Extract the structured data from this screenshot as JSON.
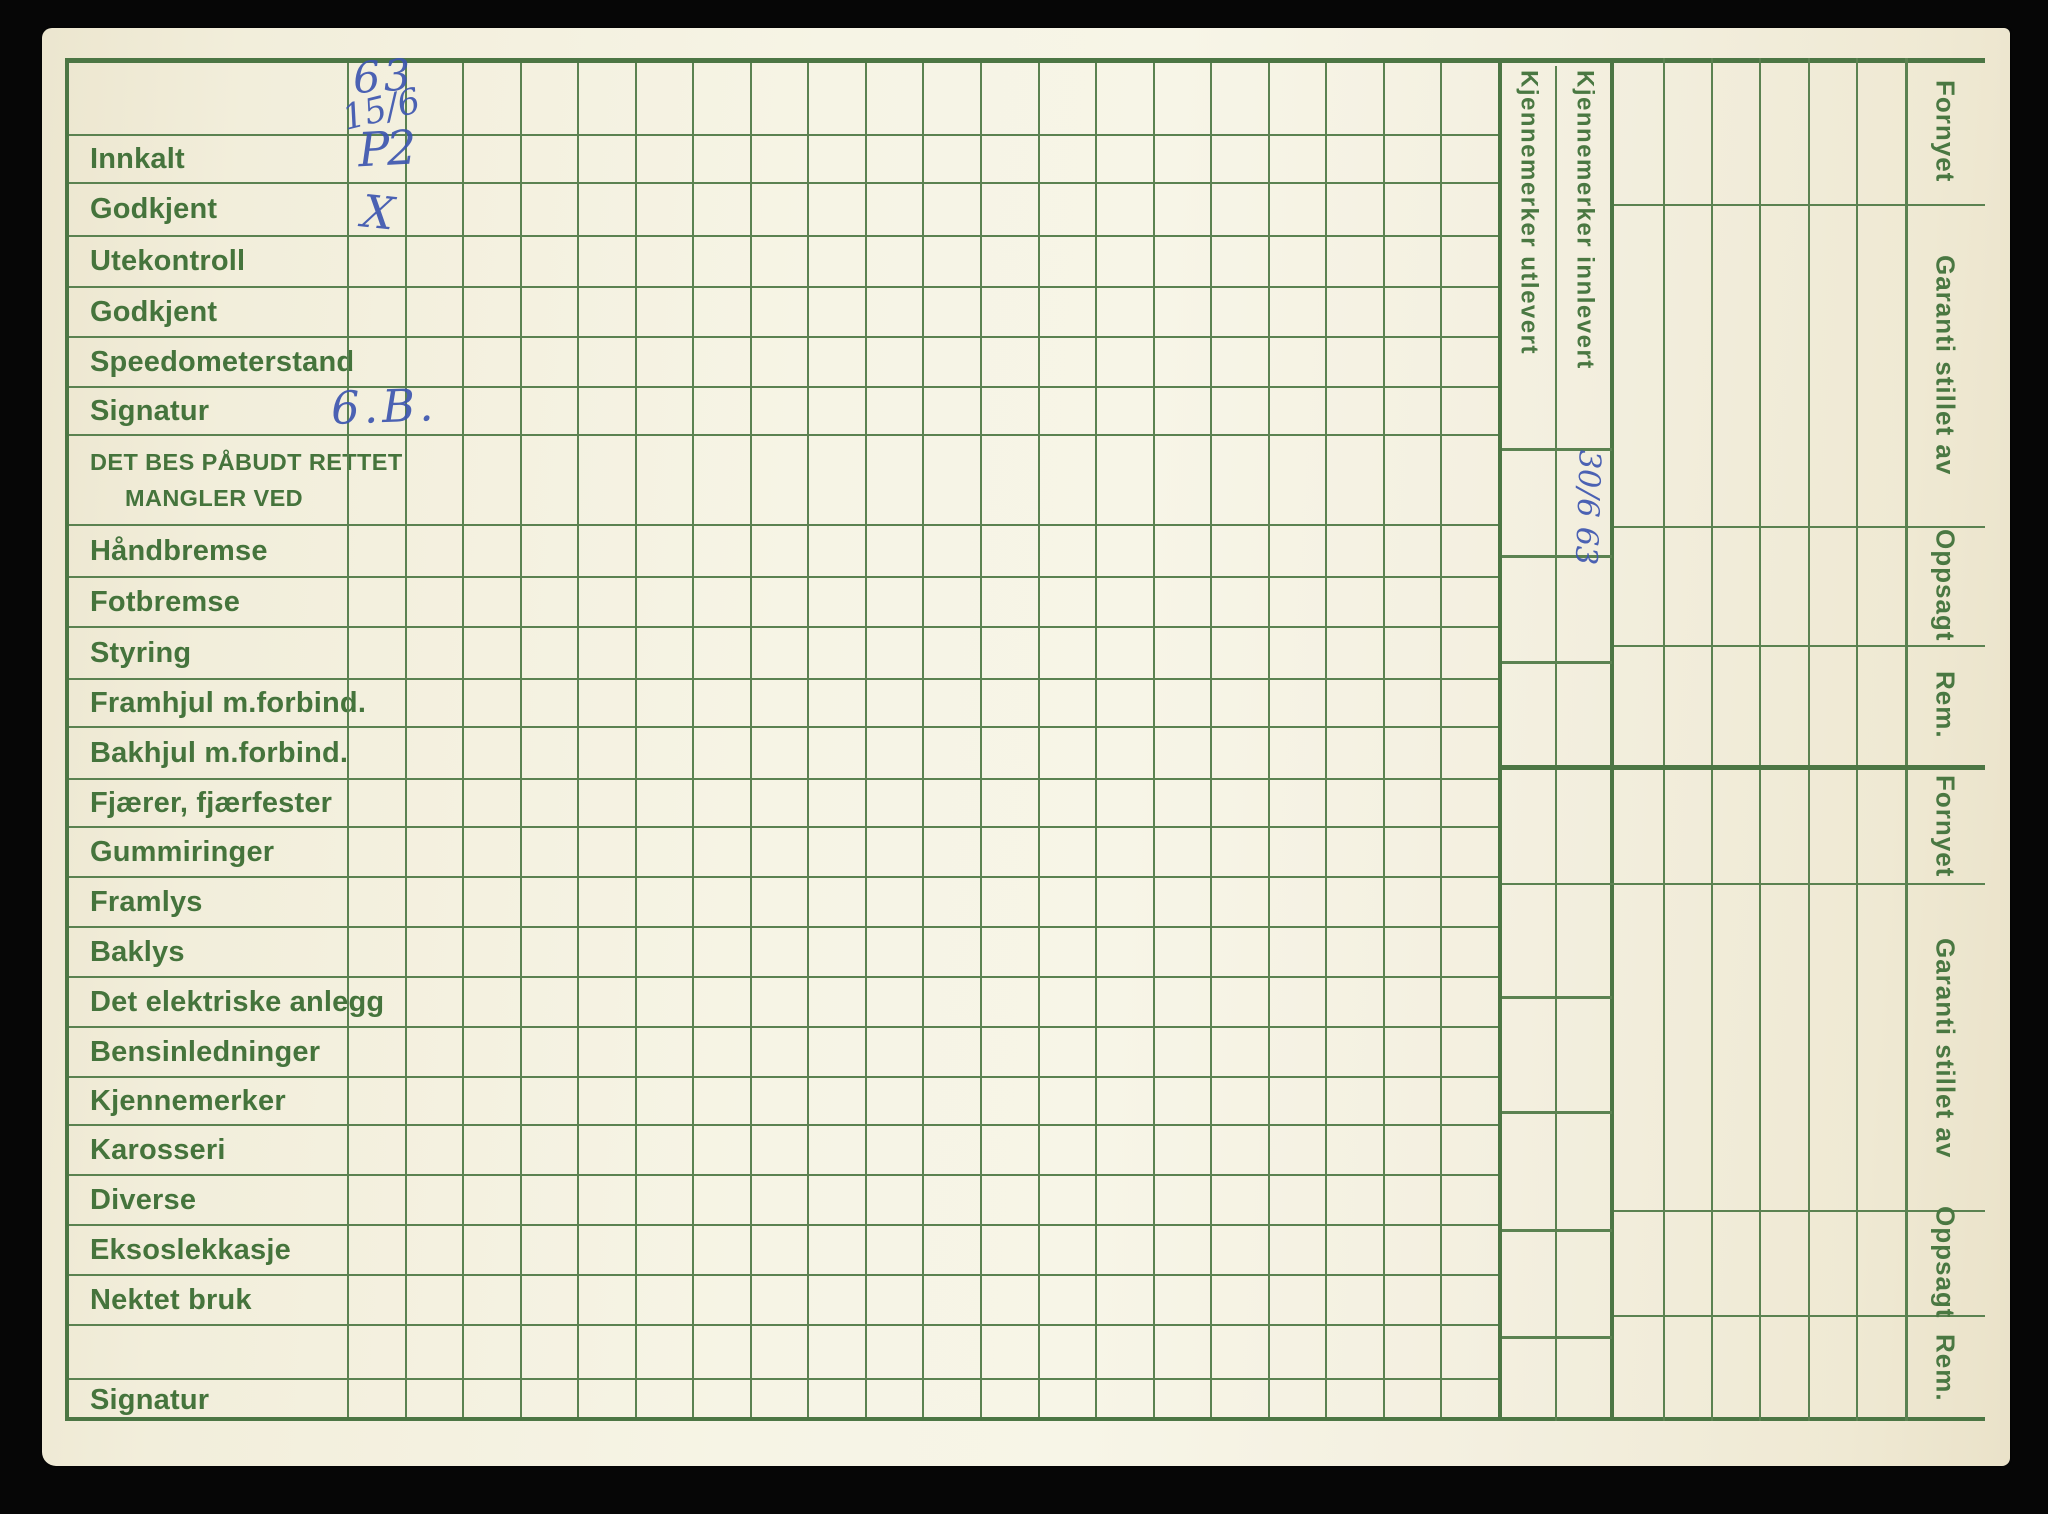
{
  "form": {
    "rows": [
      {
        "label": ""
      },
      {
        "label": "Innkalt"
      },
      {
        "label": "Godkjent"
      },
      {
        "label": "Utekontroll"
      },
      {
        "label": "Godkjent"
      },
      {
        "label": "Speedometerstand"
      },
      {
        "label": "Signatur"
      },
      {
        "label": "DET BES PÅBUDT RETTET",
        "label2": "MANGLER VED"
      },
      {
        "label": "Håndbremse"
      },
      {
        "label": "Fotbremse"
      },
      {
        "label": "Styring"
      },
      {
        "label": "Framhjul m.forbind."
      },
      {
        "label": "Bakhjul m.forbind."
      },
      {
        "label": "Fjærer, fjærfester"
      },
      {
        "label": "Gummiringer"
      },
      {
        "label": "Framlys"
      },
      {
        "label": "Baklys"
      },
      {
        "label": "Det elektriske anlegg"
      },
      {
        "label": "Bensinledninger"
      },
      {
        "label": "Kjennemerker"
      },
      {
        "label": "Karosseri"
      },
      {
        "label": "Diverse"
      },
      {
        "label": "Eksoslekkasje"
      },
      {
        "label": "Nektet bruk"
      },
      {
        "label": ""
      },
      {
        "label": "Signatur"
      }
    ],
    "vertical_columns": [
      {
        "label": "Kjennemerker utlevert"
      },
      {
        "label": "Kjennemerker innlevert"
      }
    ],
    "right_margin_sections": [
      {
        "label": "Fornyet"
      },
      {
        "label": "Garanti stillet av"
      },
      {
        "label": "Oppsagt"
      },
      {
        "label": "Rem."
      },
      {
        "label": "Fornyet"
      },
      {
        "label": "Garanti stillet av"
      },
      {
        "label": "Oppsagt"
      },
      {
        "label": "Rem."
      }
    ],
    "handwriting": {
      "header_year": "63",
      "header_date": "15/6",
      "innkalt_value": "P2",
      "godkjent_mark": "X",
      "signatur_value": "6.B.",
      "kjennemerker_innlevert_date": "30/6 63"
    },
    "colors": {
      "paper": "#f4f1e0",
      "grid_green": "#5b8251",
      "text_green": "#45743c",
      "ink_blue": "#3d56b0",
      "scan_background": "#060606"
    }
  }
}
